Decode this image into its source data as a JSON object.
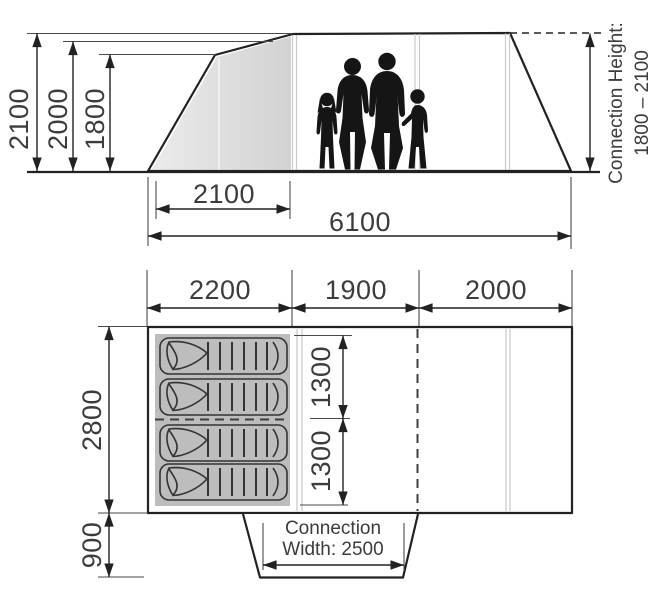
{
  "side_view": {
    "heights": [
      "2100",
      "2000",
      "1800"
    ],
    "porch_width": "2100",
    "total_length": "6100",
    "connection_height_title": "Connection Height:",
    "connection_height_range": "1800 – 2100"
  },
  "floor_plan": {
    "section_widths": [
      "2200",
      "1900",
      "2000"
    ],
    "berth_lengths": [
      "1300",
      "1300"
    ],
    "inner_width": "2800",
    "tunnel_depth": "900",
    "connection_width_title": "Connection",
    "connection_width_value": "Width: 2500"
  },
  "colors": {
    "line": "#222222",
    "text": "#3c3c3c",
    "porch_fill": "#dcdcdc",
    "sleeping_area_fill": "#bdbdbd",
    "silhouette": "#151515",
    "seam": "#c9c9c9",
    "background": "#ffffff"
  }
}
